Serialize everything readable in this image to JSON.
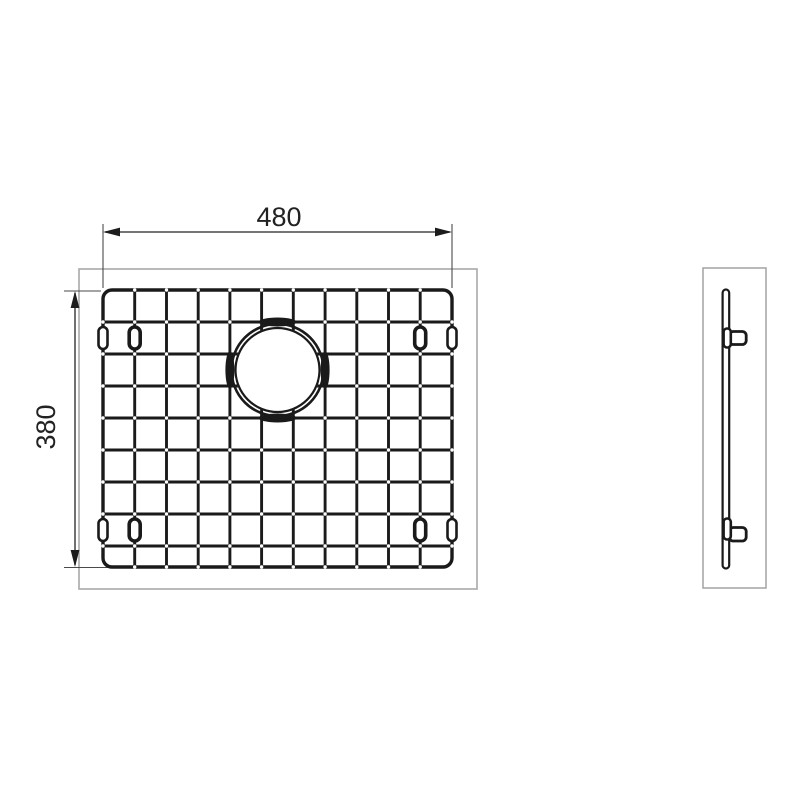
{
  "labels": {
    "width_dimension": "480",
    "height_dimension": "380"
  },
  "colors": {
    "ink": "#1a1a1a",
    "frame": "#a8a8a8",
    "paper": "#ffffff",
    "dot": "#ffffff"
  },
  "front_view": {
    "frame": {
      "x": 79,
      "y": 269,
      "w": 398,
      "h": 320
    },
    "grid": {
      "x": 103,
      "y": 290,
      "w": 349,
      "h": 277,
      "corner_radius": 9,
      "col_xs": [
        103,
        134.7,
        166.5,
        198.2,
        229.9,
        261.6,
        293.3,
        325.1,
        356.8,
        388.5,
        420.2,
        452
      ],
      "row_ys": [
        290,
        322,
        354,
        386,
        418,
        450,
        482,
        514,
        546,
        567
      ]
    },
    "hole": {
      "cx": 277.5,
      "cy": 370,
      "r_outer": 46,
      "r_inner": 42,
      "r_fill": 43,
      "tangent_cols": [
        4,
        7
      ],
      "tangent_rows": [
        1,
        4
      ],
      "dot_exclusion_radius": 52
    },
    "feet": [
      {
        "cx": 134.7,
        "cy": 338
      },
      {
        "cx": 420.2,
        "cy": 338
      },
      {
        "cx": 134.7,
        "cy": 530
      },
      {
        "cx": 420.2,
        "cy": 530
      }
    ],
    "edge_clips": [
      {
        "cx": 103,
        "cy": 338
      },
      {
        "cx": 452,
        "cy": 338
      },
      {
        "cx": 103,
        "cy": 530
      },
      {
        "cx": 452,
        "cy": 530
      }
    ]
  },
  "side_view": {
    "frame": {
      "x": 703,
      "y": 268,
      "w": 63,
      "h": 320
    },
    "bar": {
      "x": 722.6,
      "y": 289.5,
      "w": 6.6,
      "h": 279
    },
    "clips": [
      {
        "foot_y": 328.5,
        "foot_h": 19,
        "arm_y": 331.5,
        "arm_h": 13
      },
      {
        "foot_y": 518.5,
        "foot_h": 21,
        "arm_y": 527.5,
        "arm_h": 13.5
      }
    ]
  }
}
